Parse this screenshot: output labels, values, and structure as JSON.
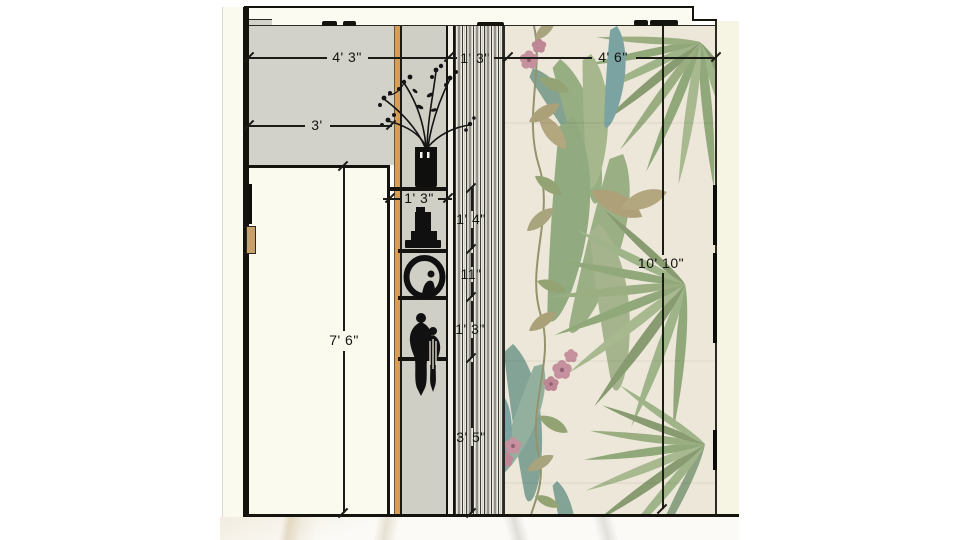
{
  "drawing": {
    "type": "interior-wall-elevation",
    "dims": {
      "w_left": "4' 3\"",
      "w_slats": "1' 3\"",
      "w_wallpaper": "4' 6\"",
      "w_door": "3'",
      "w_niche": "1' 3\"",
      "h_shelf_gap1": "1' 4\"",
      "h_shelf_gap2": "11\"",
      "h_shelf_gap3": "1' 3\"",
      "h_shelf_gap4": "3' 5\"",
      "h_door": "7' 6\"",
      "h_wall": "10' 10\""
    },
    "decor_items": [
      "vase-with-branches",
      "stacked-sculpture",
      "ring-sculpture",
      "figurine-couple"
    ],
    "colors": {
      "wall_gray": "#d2d2ca",
      "door_cream": "#fbfaef",
      "wood_trim": "#d79e56",
      "cove_white": "#fcfbf2",
      "wallpaper_cream": "#ece7d9",
      "palm_green": "#93a87c",
      "palm_teal": "#7ea093",
      "flower_pink": "#c48d9c",
      "line_black": "#1b1b17",
      "floor_marble": "#fbfaf6",
      "side_return_cream": "#f6f4e3"
    }
  }
}
